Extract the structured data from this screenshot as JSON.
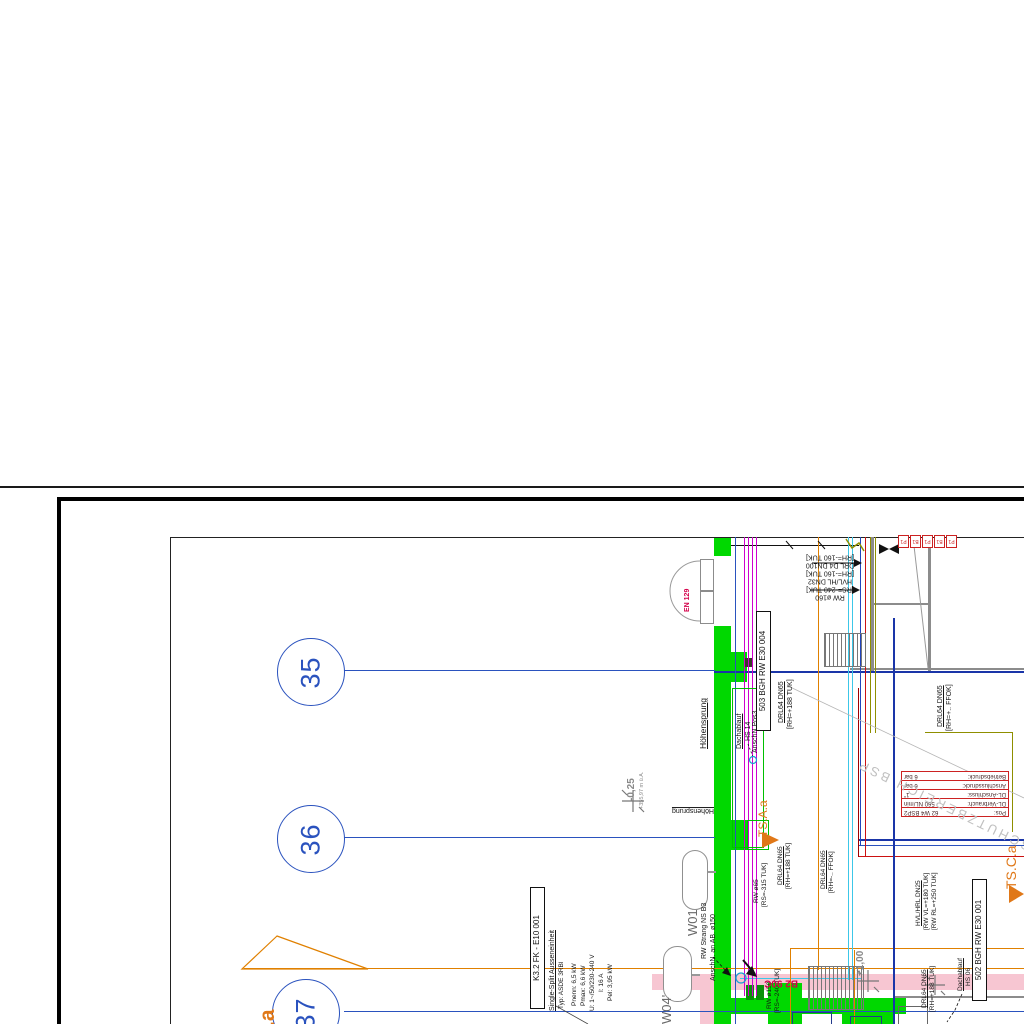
{
  "drawing": {
    "type": "architectural floor plan sheet (rotated building services plan)",
    "colors": {
      "wall_green": "#00d800",
      "accent_orange": "#e07818",
      "grid_blue": "#2a52be",
      "magenta": "#cf00cf",
      "pink_wall": "#f7c6d2",
      "red_line": "#cc1111",
      "olive": "#8f8f00",
      "cyan": "#3cc7e8",
      "crimson_label": "#d4004a"
    },
    "grid_bubbles": [
      {
        "label": "35"
      },
      {
        "label": "36"
      },
      {
        "label": "37"
      }
    ],
    "red_table": {
      "rows": [
        {
          "k": "Pos:",
          "v": "62 W4 BSP2"
        },
        {
          "k": "DL-Verbrauch:",
          "v": "560 NL/min"
        },
        {
          "k": "DL-Anschluss:",
          "v": "1\""
        },
        {
          "k": "Anschlussdruck:",
          "v": "6 bar"
        },
        {
          "k": "Betriebsdruck:",
          "v": "6 bar"
        }
      ]
    },
    "mini_boxes": [
      "P1",
      "B1",
      "P1",
      "B1",
      "P1"
    ],
    "annotations": [
      {
        "name": "label-hoehensprung",
        "text": "Höhensprung",
        "x": 699,
        "y": 749,
        "rot": -90,
        "fs": 8.5,
        "u": true
      },
      {
        "name": "label-hoehensprung-2",
        "text": "Höhensprung",
        "x": 664,
        "y": 806,
        "rot": 180,
        "fs": 7,
        "u": true,
        "w": 50
      },
      {
        "name": "label-dachablauf-1",
        "text": "Dachablauf",
        "x": 736,
        "y": 749,
        "rot": -90,
        "fs": 7,
        "u": true
      },
      {
        "name": "label-hs14",
        "text": "HS 14",
        "x": 745,
        "y": 741,
        "rot": -90,
        "fs": 7
      },
      {
        "name": "label-anschn-pos3",
        "text": "AnschN.Pos3",
        "x": 752,
        "y": 753,
        "rot": -90,
        "fs": 7
      },
      {
        "name": "label-503-box",
        "text": "503  BGH  RW  E30 004",
        "x": 756,
        "y": 731,
        "rot": -90,
        "fs": 8,
        "box": true,
        "w": 114,
        "align": "center"
      },
      {
        "name": "label-drl-1a",
        "text": "DRL64 DN65",
        "x": 778,
        "y": 723,
        "rot": -90,
        "fs": 7,
        "u": true
      },
      {
        "name": "label-drl-1b",
        "text": "[RH=+188 TUK]",
        "x": 787,
        "y": 729,
        "rot": -90,
        "fs": 7
      },
      {
        "name": "label-drl-2a",
        "text": "DRL64 DN65",
        "x": 937,
        "y": 727,
        "rot": -90,
        "fs": 7,
        "u": true
      },
      {
        "name": "label-drl-2b",
        "text": "[RH=+.. FFOK]",
        "x": 946,
        "y": 731,
        "rot": -90,
        "fs": 7
      },
      {
        "name": "label-pipe-stack",
        "text": "RW ø160\n[RS=-240 TUK]\nHVL/HL DN32\n[RH=-160 TUK]\nDRL D4 DN100\n[RH=-160 TUK]",
        "x": 787,
        "y": 552,
        "rot": 180,
        "fs": 7,
        "w": 86,
        "align": "center"
      },
      {
        "name": "label-door-en129",
        "text": "EN 129",
        "x": 684,
        "y": 612,
        "rot": -90,
        "fs": 7,
        "color": "#d4004a",
        "b": true
      },
      {
        "name": "label-rw65",
        "text": "RW ø65",
        "x": 753,
        "y": 903,
        "rot": -90,
        "fs": 6.5
      },
      {
        "name": "label-rs315",
        "text": "[RS=-315 TUK]",
        "x": 761,
        "y": 907,
        "rot": -90,
        "fs": 6.5
      },
      {
        "name": "label-drl-3a",
        "text": "DRL64 DN65",
        "x": 777,
        "y": 885,
        "rot": -90,
        "fs": 6.5,
        "u": true
      },
      {
        "name": "label-drl-3b",
        "text": "[RH=+188 TUK]",
        "x": 785,
        "y": 889,
        "rot": -90,
        "fs": 6.5
      },
      {
        "name": "label-drl-4a",
        "text": "DRL64 DN65",
        "x": 820,
        "y": 889,
        "rot": -90,
        "fs": 6.5,
        "u": true
      },
      {
        "name": "label-drl-4b",
        "text": "[RH=-.. FFOK]",
        "x": 828,
        "y": 893,
        "rot": -90,
        "fs": 6.5
      },
      {
        "name": "label-rw150",
        "text": "RW ø150",
        "x": 766,
        "y": 1009,
        "rot": -90,
        "fs": 6.5
      },
      {
        "name": "label-rs240",
        "text": "[RS=-240 TUK]",
        "x": 774,
        "y": 1013,
        "rot": -90,
        "fs": 6.5
      },
      {
        "name": "label-rw-strang",
        "text": "RW Strang NS B3",
        "x": 701,
        "y": 959,
        "rot": -90,
        "fs": 7
      },
      {
        "name": "label-anschn-ab150",
        "text": "AnschN. an AB. ø150",
        "x": 710,
        "y": 981,
        "rot": -90,
        "fs": 7
      },
      {
        "name": "label-w01",
        "text": "W01",
        "x": 686,
        "y": 936,
        "rot": -90,
        "fs": 13,
        "color": "#6a6a6a"
      },
      {
        "name": "label-w04",
        "text": "W04'",
        "x": 660,
        "y": 1024,
        "rot": -90,
        "fs": 13,
        "color": "#6a6a6a"
      },
      {
        "name": "label-k32-box",
        "text": "K3.2  FK  -  E10 001",
        "x": 530,
        "y": 1009,
        "rot": -90,
        "fs": 8,
        "box": true,
        "w": 116,
        "align": "center"
      },
      {
        "name": "label-k32-title",
        "text": "Single-Split Ausseneinheit",
        "x": 549,
        "y": 1011,
        "rot": -90,
        "fs": 7,
        "u": true
      },
      {
        "name": "label-k32-typ",
        "text": "Typ: ASDE 3RBl",
        "x": 558,
        "y": 1009,
        "rot": -90,
        "fs": 6.5
      },
      {
        "name": "label-k32-pnenn",
        "text": "Pnenn: 6,5 kW",
        "x": 571,
        "y": 1006,
        "rot": -90,
        "fs": 6.5
      },
      {
        "name": "label-k32-pmax",
        "text": "Pmax: 6,6 kW",
        "x": 580,
        "y": 1006,
        "rot": -90,
        "fs": 6.5
      },
      {
        "name": "label-k32-u",
        "text": "U: 1~/50/230-240 V",
        "x": 589,
        "y": 1011,
        "rot": -90,
        "fs": 6.5
      },
      {
        "name": "label-k32-i",
        "text": "I: 16 A",
        "x": 598,
        "y": 992,
        "rot": -90,
        "fs": 6.5
      },
      {
        "name": "label-k32-pel",
        "text": "Pel: 3,95 kW",
        "x": 607,
        "y": 1001,
        "rot": -90,
        "fs": 6.5
      },
      {
        "name": "label-b2-90c",
        "text": "B2 90C",
        "x": 756,
        "y": 977,
        "rot": 180,
        "fs": 10,
        "color": "#d4004a",
        "b": true,
        "w": 42
      },
      {
        "name": "label-elev-minus025",
        "text": "-0,25",
        "x": 626,
        "y": 801,
        "rot": -90,
        "fs": 10,
        "color": "#8a8a8a",
        "b": true
      },
      {
        "name": "label-elev-355",
        "text": "+355,97 m ü.A.",
        "x": 639,
        "y": 809,
        "rot": -90,
        "fs": 5.5,
        "color": "#8a8a8a"
      },
      {
        "name": "label-elev-plus100",
        "text": "+1,00",
        "x": 855,
        "y": 976,
        "rot": -90,
        "fs": 10,
        "color": "#8a8a8a",
        "b": true
      },
      {
        "name": "label-hvl",
        "text": "HVL/HRL DN25",
        "x": 915,
        "y": 926,
        "rot": -90,
        "fs": 6.5,
        "u": true
      },
      {
        "name": "label-hvl-vl",
        "text": "[RW VL=+180 TUK]",
        "x": 923,
        "y": 930,
        "rot": -90,
        "fs": 6.5
      },
      {
        "name": "label-hvl-rl",
        "text": "[RW RL=+250 TUK]",
        "x": 931,
        "y": 930,
        "rot": -90,
        "fs": 6.5
      },
      {
        "name": "label-drl-5a",
        "text": "DRL64 DN65",
        "x": 921,
        "y": 1008,
        "rot": -90,
        "fs": 6.5,
        "u": true
      },
      {
        "name": "label-drl-5b",
        "text": "[RH=+188 TUK]",
        "x": 929,
        "y": 1012,
        "rot": -90,
        "fs": 6.5
      },
      {
        "name": "label-dachablauf-2",
        "text": "Dachablauf",
        "x": 957,
        "y": 991,
        "rot": -90,
        "fs": 6.5,
        "u": true
      },
      {
        "name": "label-hs06",
        "text": "HS 06",
        "x": 965,
        "y": 986,
        "rot": -90,
        "fs": 6.5
      },
      {
        "name": "label-502-box",
        "text": "502  BGH  RW  E30 001",
        "x": 972,
        "y": 1001,
        "rot": -90,
        "fs": 8,
        "box": true,
        "w": 116,
        "align": "center"
      },
      {
        "name": "label-ts-c-a",
        "text": "TS.C.a",
        "x": 1003,
        "y": 889,
        "rot": -90,
        "fs": 14,
        "color": "#e07818"
      },
      {
        "name": "label-ts-a-a",
        "text": "TS.A.a",
        "x": 757,
        "y": 837,
        "rot": -90,
        "fs": 12,
        "color": "#e07818"
      },
      {
        "name": "label-ts-partial",
        "text": "f.a",
        "x": 256,
        "y": 1034,
        "rot": -90,
        "fs": 21,
        "color": "#e07818",
        "b": true
      },
      {
        "name": "watermark-schutzbereich",
        "text": "SCHUTZBEREICH BSP",
        "x": 840,
        "y": 795,
        "rot": 206,
        "fs": 13,
        "color": "#c0c0c0",
        "ls": 3,
        "w": 200
      }
    ]
  }
}
